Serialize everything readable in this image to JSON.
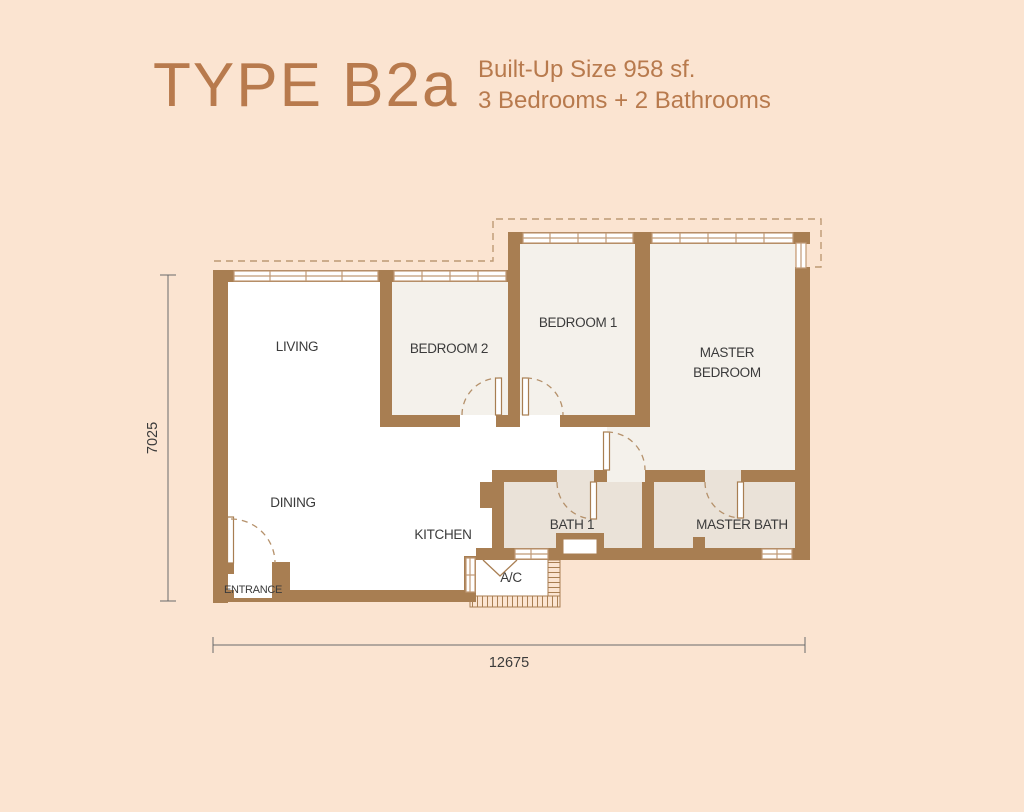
{
  "header": {
    "title": "TYPE B2a",
    "builtup": "Built-Up Size 958 sf.",
    "config": "3 Bedrooms + 2 Bathrooms"
  },
  "plan": {
    "rooms": [
      {
        "label": "LIVING"
      },
      {
        "label": "DINING"
      },
      {
        "label": "KITCHEN"
      },
      {
        "label": "BEDROOM 2"
      },
      {
        "label": "BEDROOM 1"
      },
      {
        "label": "MASTER BEDROOM",
        "lines": [
          "MASTER",
          "BEDROOM"
        ]
      },
      {
        "label": "BATH 1"
      },
      {
        "label": "MASTER BATH"
      },
      {
        "label": "ENTRANCE"
      },
      {
        "label": "A/C"
      }
    ],
    "dimensions": {
      "width": "12675",
      "height": "7025"
    }
  },
  "colors": {
    "background": "#fbe4d1",
    "wall": "#a87e52",
    "accent": "#b87a4d",
    "room_light": "#f4f1eb",
    "bath": "#eae2d8",
    "label": "#3b3b3b",
    "window_line": "#c09a76"
  }
}
